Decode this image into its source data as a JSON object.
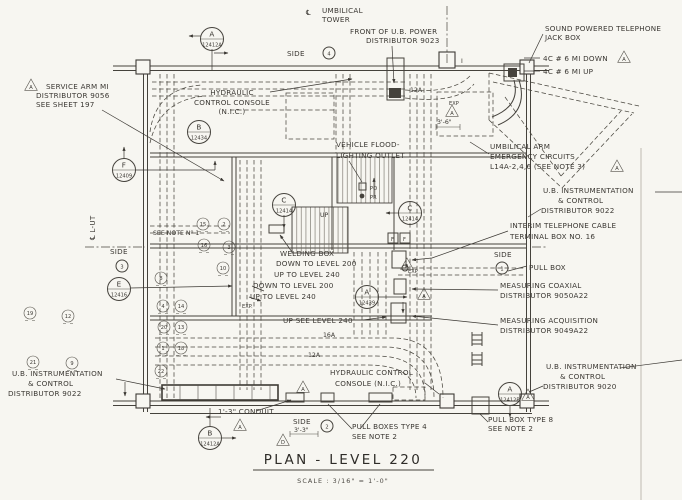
{
  "drawing": {
    "title": "PLAN  -  LEVEL  220",
    "scale_label": "SCALE : 3/16\" = 1'-0\""
  },
  "labels": {
    "cl_sym_top": "℄",
    "umbilical_tower": {
      "l1": "UMBILICAL",
      "l2": "TOWER"
    },
    "front_power": {
      "l1": "FRONT OF U.B. POWER",
      "l2": "DISTRIBUTOR 9023"
    },
    "sound_tel": {
      "l1": "SOUND POWERED TELEPHONE",
      "l2": "JACK BOX"
    },
    "mi_down": "4C # 6 MI DOWN",
    "mi_up": "4C # 6 MI UP",
    "service_arm": {
      "l1": "SERVICE ARM MI",
      "l2": "DISTRIBUTOR 9056",
      "l3": "SEE SHEET 197"
    },
    "hyd_console_top": {
      "l1": "HYDRAULIC",
      "l2": "CONTROL CONSOLE",
      "l3": "(N.I.C.)"
    },
    "vehicle_flood": {
      "l1": "VEHICLE FLOOD-",
      "l2": "LIGHTING OUTLET"
    },
    "po": "PO",
    "pr": "PR",
    "up1": "UP",
    "umb_arm": {
      "l1": "UMBILICAL ARM",
      "l2": "EMERGENCY CIRCUITS",
      "l3": "L14A-2,4,6 (SEE NOTE 3)"
    },
    "instr_9022_r": {
      "l1": "U.B. INSTRUMENTATION",
      "l2": "& CONTROL",
      "l3": "DISTRIBUTOR 9022"
    },
    "interim_tel": {
      "l1": "INTERIM TELEPHONE CABLE",
      "l2": "TERMINAL BOX NO. 16"
    },
    "pull_box": "PULL BOX",
    "meas_coax": {
      "l1": "MEASURING COAXIAL",
      "l2": "DISTRIBUTOR 9050A22"
    },
    "meas_acq": {
      "l1": "MEASURING ACQUISITION",
      "l2": "DISTRIBUTOR 9049A22"
    },
    "instr_9020": {
      "l1": "U.B. INSTRUMENTATION",
      "l2": "& CONTROL",
      "l3": "DISTRIBUTOR 9020"
    },
    "pull_box_8": {
      "l1": "PULL BOX TYPE 8",
      "l2": "SEE NOTE 2"
    },
    "instr_9022_l": {
      "l1": "U.B. INSTRUMENTATION",
      "l2": "& CONTROL",
      "l3": "DISTRIBUTOR 9022"
    },
    "hyd_console_bot": {
      "l1": "HYDRAULIC CONTROL",
      "l2": "CONSOLE (N.I.C.)"
    },
    "conduit": "1'-3\" CONDUIT",
    "pull_boxes_4": {
      "l1": "PULL BOXES TYPE 4",
      "l2": "SEE NOTE 2"
    },
    "cl_lut": "℄ L-UT",
    "see_note1": "SEE NOTE Nº 1",
    "welding": {
      "l1": "WELDING BOX",
      "l2": "DOWN TO LEVEL 200",
      "l3": "UP TO LEVEL 240"
    },
    "down200": "DOWN TO LEVEL 200",
    "up240": "UP TO LEVEL 240",
    "up_see": "UP SEE LEVEL 240",
    "a16": "16A",
    "a12_mid": "12A",
    "a12_top": "12A",
    "exp1": "EXP.",
    "exp2": "EXP",
    "exp3": "EXP",
    "dim_3_6": "3'-6\"",
    "dim_3_3": "3'-3\"",
    "tag_i": "I",
    "f1": "F",
    "f2": "F"
  },
  "side_markers": [
    {
      "label": "SIDE",
      "num": "4",
      "lx": 287,
      "ly": 56,
      "cx": 329,
      "cy": 53
    },
    {
      "label": "SIDE",
      "num": "1",
      "lx": 494,
      "ly": 257,
      "cx": 502,
      "cy": 268
    },
    {
      "label": "SIDE",
      "num": "3",
      "lx": 110,
      "ly": 254,
      "cx": 122,
      "cy": 266
    },
    {
      "label": "SIDE",
      "num": "2",
      "lx": 293,
      "ly": 424,
      "cx": 327,
      "cy": 426
    }
  ],
  "ref_circles": [
    {
      "letter": "A",
      "number": "12412A",
      "x": 212,
      "y": 39
    },
    {
      "letter": "B",
      "number": "12434",
      "x": 199,
      "y": 132
    },
    {
      "letter": "F",
      "number": "12409",
      "x": 124,
      "y": 170
    },
    {
      "letter": "E",
      "number": "12416",
      "x": 119,
      "y": 289
    },
    {
      "letter": "C",
      "number": "12414",
      "x": 284,
      "y": 205
    },
    {
      "letter": "C",
      "number": "12414",
      "x": 410,
      "y": 213
    },
    {
      "letter": "A",
      "number": "12439",
      "x": 367,
      "y": 297
    },
    {
      "letter": "A",
      "number": "12412B",
      "x": 510,
      "y": 394
    },
    {
      "letter": "B",
      "number": "12412A",
      "x": 210,
      "y": 438
    }
  ],
  "plan_marks": [
    {
      "n": "15",
      "x": 203,
      "y": 224
    },
    {
      "n": "2",
      "x": 224,
      "y": 224
    },
    {
      "n": "16",
      "x": 204,
      "y": 245
    },
    {
      "n": "3",
      "x": 229,
      "y": 247
    },
    {
      "n": "10",
      "x": 223,
      "y": 268
    },
    {
      "n": "8",
      "x": 161,
      "y": 278
    },
    {
      "n": "4",
      "x": 163,
      "y": 306
    },
    {
      "n": "14",
      "x": 181,
      "y": 306
    },
    {
      "n": "20",
      "x": 164,
      "y": 327
    },
    {
      "n": "13",
      "x": 181,
      "y": 327
    },
    {
      "n": "1",
      "x": 163,
      "y": 348
    },
    {
      "n": "18",
      "x": 181,
      "y": 348
    },
    {
      "n": "22",
      "x": 161,
      "y": 371
    },
    {
      "n": "19",
      "x": 30,
      "y": 313
    },
    {
      "n": "12",
      "x": 68,
      "y": 316
    },
    {
      "n": "21",
      "x": 33,
      "y": 362
    },
    {
      "n": "9",
      "x": 72,
      "y": 363
    }
  ],
  "triangles": [
    {
      "letter": "A",
      "x": 31,
      "y": 86
    },
    {
      "letter": "A",
      "x": 624,
      "y": 58
    },
    {
      "letter": "A",
      "x": 617,
      "y": 167
    },
    {
      "letter": "A",
      "x": 452,
      "y": 112
    },
    {
      "letter": "A",
      "x": 407,
      "y": 265
    },
    {
      "letter": "A",
      "x": 424,
      "y": 295
    },
    {
      "letter": "A",
      "x": 528,
      "y": 396
    },
    {
      "letter": "A",
      "x": 240,
      "y": 426
    },
    {
      "letter": "D",
      "x": 283,
      "y": 441
    },
    {
      "letter": "A",
      "x": 303,
      "y": 388
    }
  ]
}
